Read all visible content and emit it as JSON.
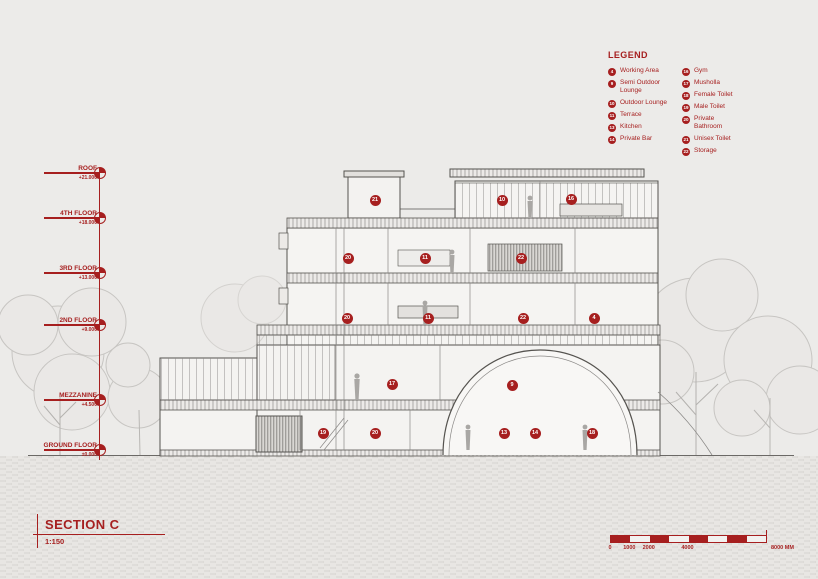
{
  "accent_color": "#a61f1f",
  "background_color": "#ecebe9",
  "title_block": {
    "title": "SECTION C",
    "scale": "1:150"
  },
  "legend": {
    "title": "LEGEND",
    "columns": [
      {
        "items": [
          {
            "num": "4",
            "label": "Working Area"
          },
          {
            "num": "9",
            "label": "Semi Outdoor Lounge"
          },
          {
            "num": "10",
            "label": "Outdoor Lounge"
          },
          {
            "num": "11",
            "label": "Terrace"
          },
          {
            "num": "13",
            "label": "Kitchen"
          },
          {
            "num": "14",
            "label": "Private Bar"
          }
        ]
      },
      {
        "items": [
          {
            "num": "16",
            "label": "Gym"
          },
          {
            "num": "17",
            "label": "Musholla"
          },
          {
            "num": "18",
            "label": "Female Toilet"
          },
          {
            "num": "19",
            "label": "Male Toilet"
          },
          {
            "num": "20",
            "label": "Private Bathroom"
          },
          {
            "num": "21",
            "label": "Unisex Toilet"
          },
          {
            "num": "22",
            "label": "Storage"
          }
        ]
      }
    ]
  },
  "levels": [
    {
      "label": "ROOF",
      "elevation": "+21.000",
      "y": 173
    },
    {
      "label": "4TH FLOOR",
      "elevation": "+18.000",
      "y": 218
    },
    {
      "label": "3RD FLOOR",
      "elevation": "+13.000",
      "y": 273
    },
    {
      "label": "2ND FLOOR",
      "elevation": "+9.000",
      "y": 325
    },
    {
      "label": "MEZZANINE",
      "elevation": "+4.500",
      "y": 400
    },
    {
      "label": "GROUND FLOOR",
      "elevation": "±0.000",
      "y": 450
    }
  ],
  "room_markers": [
    {
      "num": "21",
      "x": 375,
      "y": 200
    },
    {
      "num": "10",
      "x": 502,
      "y": 200
    },
    {
      "num": "16",
      "x": 571,
      "y": 199
    },
    {
      "num": "20",
      "x": 348,
      "y": 258
    },
    {
      "num": "11",
      "x": 425,
      "y": 258
    },
    {
      "num": "22",
      "x": 521,
      "y": 258
    },
    {
      "num": "20",
      "x": 347,
      "y": 318
    },
    {
      "num": "11",
      "x": 428,
      "y": 318
    },
    {
      "num": "22",
      "x": 523,
      "y": 318
    },
    {
      "num": "4",
      "x": 594,
      "y": 318
    },
    {
      "num": "17",
      "x": 392,
      "y": 384
    },
    {
      "num": "9",
      "x": 512,
      "y": 385
    },
    {
      "num": "19",
      "x": 323,
      "y": 433
    },
    {
      "num": "20",
      "x": 375,
      "y": 433
    },
    {
      "num": "13",
      "x": 504,
      "y": 433
    },
    {
      "num": "14",
      "x": 535,
      "y": 433
    },
    {
      "num": "18",
      "x": 592,
      "y": 433
    }
  ],
  "scale_bar": {
    "tick_labels": [
      {
        "text": "0",
        "mm": 0
      },
      {
        "text": "1000",
        "mm": 1000
      },
      {
        "text": "2000",
        "mm": 2000
      },
      {
        "text": "4000",
        "mm": 4000
      }
    ],
    "end_label": "8000 MM",
    "total_mm": 8000,
    "segments": 8
  }
}
